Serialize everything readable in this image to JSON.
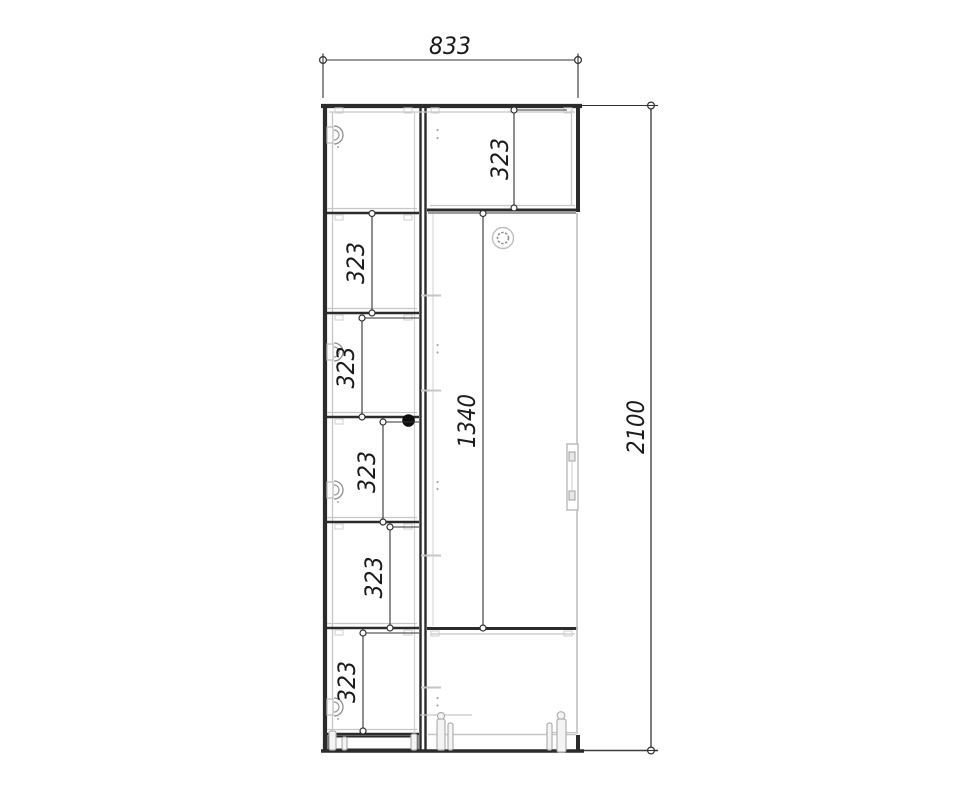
{
  "drawing": {
    "type": "furniture-technical-drawing",
    "subject": "wardrobe front elevation",
    "dims": {
      "overall_width": "833",
      "overall_height": "2100",
      "top_right_section": "323",
      "door_section": "1340",
      "left_shelf_spacings": [
        "323",
        "323",
        "323",
        "323",
        "323"
      ]
    },
    "colors": {
      "structure": "#2b2b2b",
      "secondary_lines": "#c6c6c6",
      "dimension_lines": "#333333",
      "text": "#1b1b1b",
      "background": "#ffffff"
    },
    "icons": [
      "hinge-icon",
      "lock-icon",
      "handle-icon",
      "foot-icon",
      "pin-hole-dots",
      "dot-marker"
    ]
  }
}
